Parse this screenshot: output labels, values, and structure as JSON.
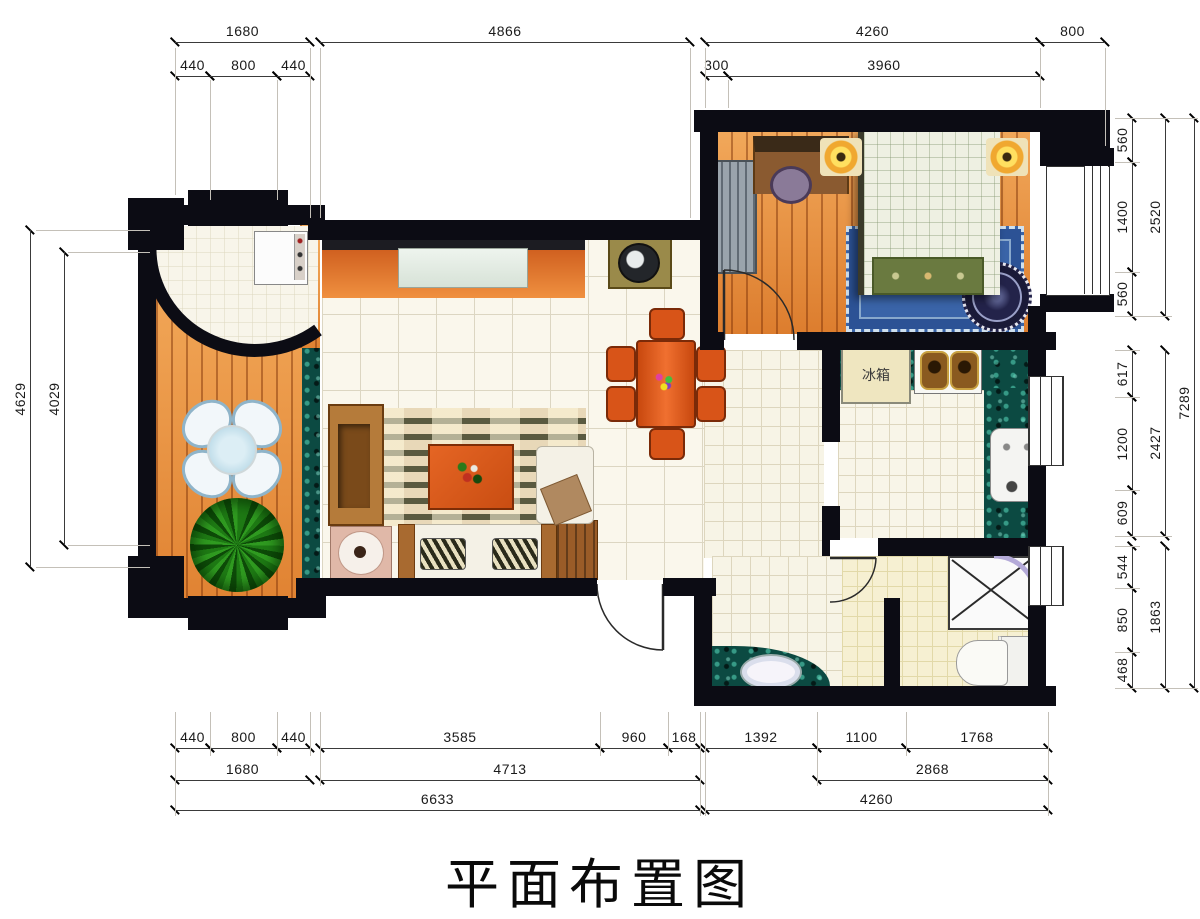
{
  "title": "平面布置图",
  "labels": {
    "fridge": "冰箱"
  },
  "dimensions": [
    {
      "label": "1680",
      "orient": "h",
      "from": 175,
      "to": 310,
      "at": 42
    },
    {
      "label": "4866",
      "orient": "h",
      "from": 320,
      "to": 690,
      "at": 42
    },
    {
      "label": "4260",
      "orient": "h",
      "from": 705,
      "to": 1040,
      "at": 42
    },
    {
      "label": "800",
      "orient": "h",
      "from": 1040,
      "to": 1105,
      "at": 42
    },
    {
      "label": "440",
      "orient": "h",
      "from": 175,
      "to": 210,
      "at": 76
    },
    {
      "label": "800",
      "orient": "h",
      "from": 210,
      "to": 277,
      "at": 76
    },
    {
      "label": "440",
      "orient": "h",
      "from": 277,
      "to": 310,
      "at": 76
    },
    {
      "label": "300",
      "orient": "h",
      "from": 705,
      "to": 728,
      "at": 76
    },
    {
      "label": "3960",
      "orient": "h",
      "from": 728,
      "to": 1040,
      "at": 76
    },
    {
      "label": "4629",
      "orient": "v",
      "from": 230,
      "to": 567,
      "at": 30
    },
    {
      "label": "4029",
      "orient": "v",
      "from": 252,
      "to": 545,
      "at": 64
    },
    {
      "label": "560",
      "orient": "v",
      "from": 118,
      "to": 162,
      "at": 1132
    },
    {
      "label": "1400",
      "orient": "v",
      "from": 162,
      "to": 272,
      "at": 1132
    },
    {
      "label": "560",
      "orient": "v",
      "from": 272,
      "to": 316,
      "at": 1132
    },
    {
      "label": "617",
      "orient": "v",
      "from": 350,
      "to": 397,
      "at": 1132
    },
    {
      "label": "1200",
      "orient": "v",
      "from": 397,
      "to": 490,
      "at": 1132
    },
    {
      "label": "609",
      "orient": "v",
      "from": 490,
      "to": 536,
      "at": 1132
    },
    {
      "label": "544",
      "orient": "v",
      "from": 546,
      "to": 588,
      "at": 1132
    },
    {
      "label": "850",
      "orient": "v",
      "from": 588,
      "to": 652,
      "at": 1132
    },
    {
      "label": "468",
      "orient": "v",
      "from": 652,
      "to": 688,
      "at": 1132
    },
    {
      "label": "2520",
      "orient": "v",
      "from": 118,
      "to": 316,
      "at": 1165
    },
    {
      "label": "2427",
      "orient": "v",
      "from": 350,
      "to": 536,
      "at": 1165
    },
    {
      "label": "1863",
      "orient": "v",
      "from": 546,
      "to": 688,
      "at": 1165
    },
    {
      "label": "7289",
      "orient": "v",
      "from": 118,
      "to": 688,
      "at": 1194
    },
    {
      "label": "440",
      "orient": "h",
      "from": 175,
      "to": 210,
      "at": 748
    },
    {
      "label": "800",
      "orient": "h",
      "from": 210,
      "to": 277,
      "at": 748
    },
    {
      "label": "440",
      "orient": "h",
      "from": 277,
      "to": 310,
      "at": 748
    },
    {
      "label": "3585",
      "orient": "h",
      "from": 320,
      "to": 600,
      "at": 748
    },
    {
      "label": "960",
      "orient": "h",
      "from": 600,
      "to": 668,
      "at": 748
    },
    {
      "label": "168",
      "orient": "h",
      "from": 668,
      "to": 700,
      "at": 748
    },
    {
      "label": "1392",
      "orient": "h",
      "from": 705,
      "to": 817,
      "at": 748
    },
    {
      "label": "1100",
      "orient": "h",
      "from": 817,
      "to": 906,
      "at": 748
    },
    {
      "label": "1768",
      "orient": "h",
      "from": 906,
      "to": 1048,
      "at": 748
    },
    {
      "label": "1680",
      "orient": "h",
      "from": 175,
      "to": 310,
      "at": 780
    },
    {
      "label": "4713",
      "orient": "h",
      "from": 320,
      "to": 700,
      "at": 780
    },
    {
      "label": "2868",
      "orient": "h",
      "from": 817,
      "to": 1048,
      "at": 780
    },
    {
      "label": "6633",
      "orient": "h",
      "from": 175,
      "to": 700,
      "at": 810
    },
    {
      "label": "4260",
      "orient": "h",
      "from": 705,
      "to": 1048,
      "at": 810
    }
  ]
}
